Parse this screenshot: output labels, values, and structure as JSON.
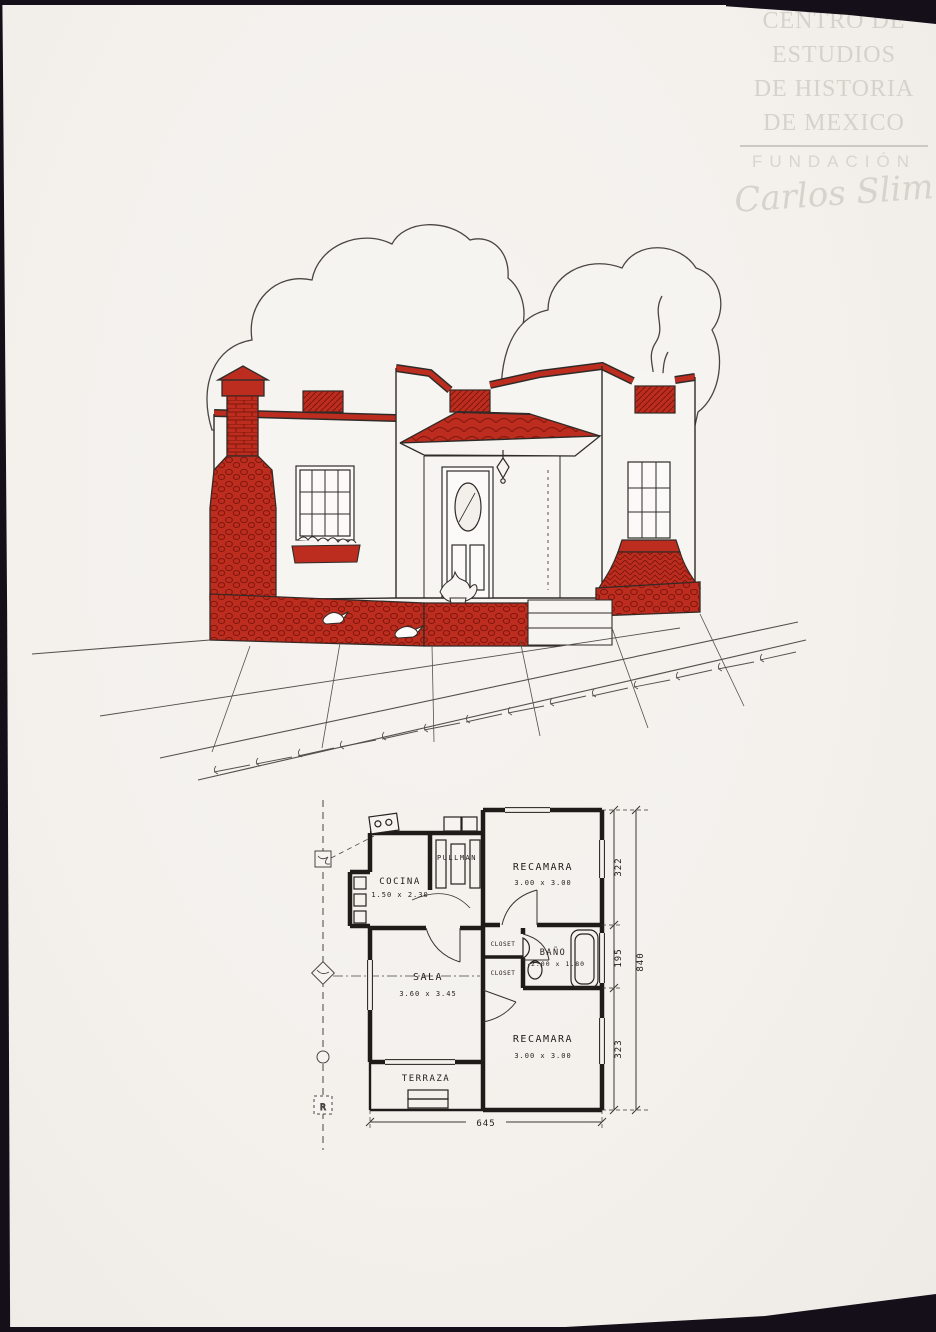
{
  "watermark": {
    "institution_lines": [
      "CENTRO DE",
      "ESTUDIOS",
      "DE HISTORIA",
      "DE MEXICO"
    ],
    "foundation": "FUNDACIÓN",
    "signature": "Carlos Slim"
  },
  "palette": {
    "paper": "#f4f1ed",
    "ink": "#3a3633",
    "plan_ink": "#211d1a",
    "accent_red": "#bc2d1f",
    "accent_red_dark": "#7e150b",
    "watermark_gray": "#d5d1cb",
    "scan_edge": "#140f19"
  },
  "floor_plan": {
    "rooms": [
      {
        "id": "cocina",
        "label": "COCINA",
        "dims": "1.50 x 2.30"
      },
      {
        "id": "pullman",
        "label": "PULLMAN",
        "dims": ""
      },
      {
        "id": "recamara-1",
        "label": "RECAMARA",
        "dims": "3.00 x 3.00"
      },
      {
        "id": "bano",
        "label": "BAÑO",
        "dims": "2.00 x 1.80"
      },
      {
        "id": "sala",
        "label": "SALA",
        "dims": "3.60 x 3.45"
      },
      {
        "id": "recamara-2",
        "label": "RECAMARA",
        "dims": "3.00 x 3.00"
      },
      {
        "id": "terraza",
        "label": "TERRAZA",
        "dims": ""
      }
    ],
    "closets": [
      "CLOSET",
      "CLOSET"
    ],
    "dimensions": {
      "right_top": "322",
      "right_middle": "195",
      "right_bottom": "323",
      "right_total": "840",
      "bottom_total": "645"
    },
    "register_mark": "R"
  }
}
